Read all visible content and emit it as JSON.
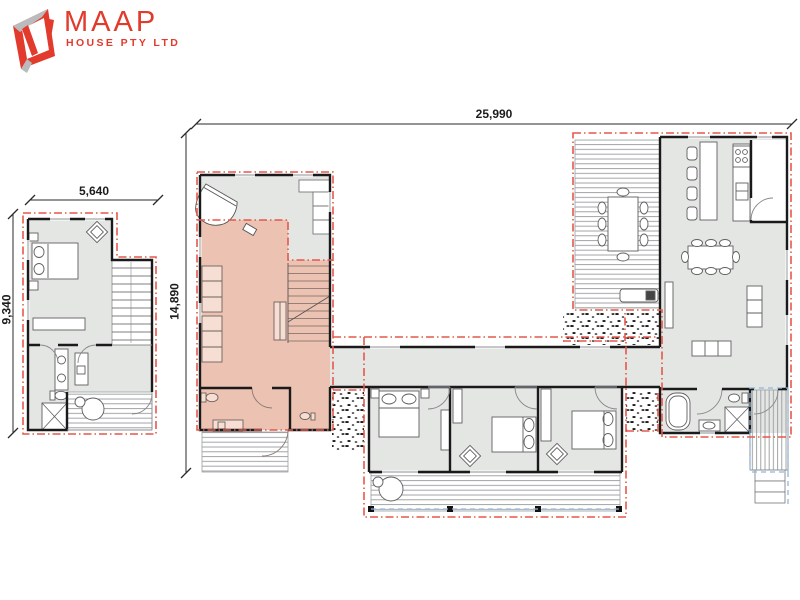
{
  "page": {
    "width": 800,
    "height": 600,
    "background": "#ffffff",
    "content": "architectural floor plan"
  },
  "logo": {
    "brand": "MAAP",
    "subtitle": "HOUSE PTY LTD"
  },
  "dimensions": {
    "overall_width": "25,990",
    "left_unit_width": "5,640",
    "left_unit_depth": "9,340",
    "centre_unit_depth": "14,890"
  },
  "colors": {
    "brand_red": "#e23a2c",
    "module_boundary_red": "#e4584c",
    "setout_blue": "#8fb7dd",
    "room_fill_grey": "#e4e6e4",
    "highlight_fill_salmon": "#ecc2b2",
    "wall_black": "#1a1a1a",
    "deck_line_grey": "#979b9c"
  },
  "plan": {
    "modules": [
      "left-unit",
      "centre-unit",
      "corridor-link",
      "bedroom-wing",
      "right-unit"
    ],
    "highlighted_module": "centre-unit",
    "icons": [
      "bed-icon",
      "pillow-icon",
      "armchair-icon",
      "stairs-icon",
      "vanity-icon",
      "toilet-icon",
      "shower-icon",
      "cafe-table-icon",
      "grand-piano-icon",
      "piano-stool-icon",
      "corner-sofa-icon",
      "modular-sofa-icon",
      "wardrobe-icon",
      "outdoor-dining-table-icon",
      "bbq-icon",
      "kitchen-island-icon",
      "stool-icon",
      "cooktop-icon",
      "sink-icon",
      "pantry-door-icon",
      "dining-table-icon",
      "sofa-icon",
      "sideboard-icon",
      "bathtub-icon",
      "basin-icon",
      "deck-boards-icon",
      "steps-icon",
      "gravel-stipple-icon",
      "door-swing-icon",
      "dimension-tick-icon"
    ]
  }
}
